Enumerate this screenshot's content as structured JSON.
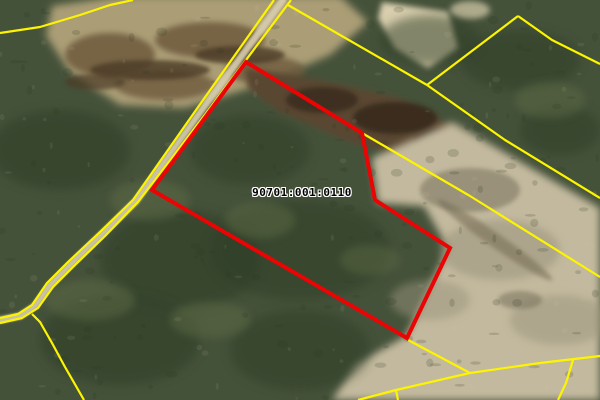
{
  "map": {
    "width": 600,
    "height": 400,
    "parcel_label": {
      "text": "90701:001:0110",
      "x": 302,
      "y": 186
    },
    "colors": {
      "boundary_yellow": "#fdf500",
      "selected_parcel_red": "#ea0404",
      "forest_base": "#45523a",
      "forest_dark": "#2a3520",
      "forest_light": "#5d6b44",
      "marsh_tan": "#ab9e76",
      "marsh_brown": "#6e5a3e",
      "marsh_dark_brown": "#46351f",
      "sand_light": "#d9cfae",
      "field_tan": "#c3b99e",
      "field_mottle": "#8f8a70",
      "road_surface": "#d8ceae",
      "label_text": "#000000",
      "label_halo": "#ffffff"
    },
    "selected_parcel": {
      "name": "selected-parcel-outline",
      "stroke_width": 4,
      "points": [
        [
          246,
          62
        ],
        [
          362,
          133
        ],
        [
          375,
          200
        ],
        [
          386,
          207
        ],
        [
          450,
          248
        ],
        [
          407,
          338
        ],
        [
          152,
          190
        ]
      ]
    },
    "cadastral_lines": [
      {
        "name": "boundary-top-left-curve",
        "points": [
          [
            0,
            33
          ],
          [
            40,
            27
          ],
          [
            80,
            15
          ],
          [
            110,
            5
          ],
          [
            133,
            0
          ]
        ]
      },
      {
        "name": "road-edge-west",
        "points": [
          [
            274,
            0
          ],
          [
            196,
            110
          ],
          [
            133,
            200
          ],
          [
            100,
            232
          ],
          [
            68,
            262
          ],
          [
            47,
            283
          ],
          [
            32,
            305
          ],
          [
            18,
            314
          ],
          [
            0,
            318
          ]
        ]
      },
      {
        "name": "road-edge-east",
        "points": [
          [
            291,
            0
          ],
          [
            207,
            112
          ],
          [
            138,
            202
          ],
          [
            105,
            236
          ],
          [
            74,
            266
          ],
          [
            53,
            287
          ],
          [
            38,
            308
          ],
          [
            22,
            318
          ],
          [
            0,
            323
          ]
        ]
      },
      {
        "name": "boundary-branch-southwest",
        "points": [
          [
            32,
            314
          ],
          [
            40,
            322
          ],
          [
            52,
            343
          ],
          [
            65,
            367
          ],
          [
            84,
            400
          ]
        ]
      },
      {
        "name": "boundary-road-to-junction",
        "points": [
          [
            288,
            5
          ],
          [
            427,
            85
          ]
        ]
      },
      {
        "name": "boundary-junction-to-peak",
        "points": [
          [
            427,
            85
          ],
          [
            518,
            16
          ]
        ]
      },
      {
        "name": "boundary-peak-east",
        "points": [
          [
            518,
            16
          ],
          [
            552,
            40
          ],
          [
            600,
            64
          ]
        ]
      },
      {
        "name": "boundary-junction-southeast",
        "points": [
          [
            427,
            85
          ],
          [
            505,
            140
          ],
          [
            600,
            198
          ]
        ]
      },
      {
        "name": "boundary-under-parcel-east",
        "points": [
          [
            362,
            133
          ],
          [
            470,
            196
          ],
          [
            600,
            277
          ]
        ]
      },
      {
        "name": "boundary-from-parcel-corner",
        "points": [
          [
            408,
            340
          ],
          [
            470,
            373
          ]
        ]
      },
      {
        "name": "boundary-bottom-long",
        "points": [
          [
            600,
            356
          ],
          [
            540,
            363
          ],
          [
            470,
            373
          ],
          [
            396,
            390
          ],
          [
            358,
            400
          ]
        ]
      },
      {
        "name": "boundary-bottom-stub",
        "points": [
          [
            396,
            390
          ],
          [
            398,
            400
          ]
        ]
      },
      {
        "name": "boundary-bottom-right-drop",
        "points": [
          [
            573,
            360
          ],
          [
            566,
            383
          ],
          [
            558,
            400
          ]
        ]
      }
    ],
    "terrain_patches": [
      {
        "name": "marsh-top-left",
        "type": "polygon",
        "fill": "#ab9e76",
        "opacity": 1,
        "blur": "f4",
        "points": [
          [
            52,
            6
          ],
          [
            120,
            -4
          ],
          [
            340,
            -4
          ],
          [
            368,
            22
          ],
          [
            330,
            55
          ],
          [
            260,
            85
          ],
          [
            185,
            108
          ],
          [
            120,
            105
          ],
          [
            70,
            72
          ],
          [
            46,
            36
          ]
        ]
      },
      {
        "name": "marsh-brown-1",
        "type": "ellipse",
        "fill": "#6e5a3e",
        "opacity": 0.85,
        "blur": "f3",
        "cx": 110,
        "cy": 55,
        "rx": 45,
        "ry": 22
      },
      {
        "name": "marsh-brown-2",
        "type": "ellipse",
        "fill": "#6e5a3e",
        "opacity": 0.85,
        "blur": "f3",
        "cx": 210,
        "cy": 40,
        "rx": 55,
        "ry": 18
      },
      {
        "name": "marsh-brown-3",
        "type": "ellipse",
        "fill": "#6e5a3e",
        "opacity": 0.8,
        "blur": "f3",
        "cx": 165,
        "cy": 85,
        "rx": 50,
        "ry": 15
      },
      {
        "name": "marsh-brown-4",
        "type": "ellipse",
        "fill": "#6e5a3e",
        "opacity": 0.8,
        "blur": "f3",
        "cx": 265,
        "cy": 70,
        "rx": 40,
        "ry": 14
      },
      {
        "name": "marsh-streak-1",
        "type": "ellipse",
        "fill": "#4c3b27",
        "opacity": 0.8,
        "blur": "f2",
        "cx": 150,
        "cy": 70,
        "rx": 60,
        "ry": 10
      },
      {
        "name": "marsh-streak-2",
        "type": "ellipse",
        "fill": "#4c3b27",
        "opacity": 0.8,
        "blur": "f2",
        "cx": 240,
        "cy": 55,
        "rx": 45,
        "ry": 9
      },
      {
        "name": "marsh-streak-3",
        "type": "ellipse",
        "fill": "#4c3b27",
        "opacity": 0.7,
        "blur": "f2",
        "cx": 95,
        "cy": 82,
        "rx": 30,
        "ry": 8
      },
      {
        "name": "parcel-marsh-band",
        "type": "polygon",
        "fill": "#5a4730",
        "opacity": 1,
        "blur": "f3",
        "points": [
          [
            245,
            68
          ],
          [
            320,
            80
          ],
          [
            400,
            98
          ],
          [
            462,
            132
          ],
          [
            470,
            152
          ],
          [
            430,
            162
          ],
          [
            350,
            142
          ],
          [
            280,
            112
          ],
          [
            248,
            88
          ]
        ]
      },
      {
        "name": "parcel-marsh-dark-1",
        "type": "ellipse",
        "fill": "#382b1b",
        "opacity": 0.9,
        "blur": "f2",
        "cx": 395,
        "cy": 118,
        "rx": 42,
        "ry": 16
      },
      {
        "name": "parcel-marsh-dark-2",
        "type": "ellipse",
        "fill": "#382b1b",
        "opacity": 0.85,
        "blur": "f2",
        "cx": 440,
        "cy": 140,
        "rx": 26,
        "ry": 12
      },
      {
        "name": "parcel-marsh-dark-3",
        "type": "ellipse",
        "fill": "#382b1b",
        "opacity": 0.8,
        "blur": "f2",
        "cx": 322,
        "cy": 100,
        "rx": 36,
        "ry": 13
      },
      {
        "name": "sand-top-right",
        "type": "polygon",
        "fill": "#d9cfae",
        "opacity": 1,
        "blur": "f3",
        "points": [
          [
            382,
            2
          ],
          [
            448,
            12
          ],
          [
            458,
            48
          ],
          [
            428,
            68
          ],
          [
            395,
            48
          ],
          [
            378,
            18
          ]
        ]
      },
      {
        "name": "sand-top-right-2",
        "type": "ellipse",
        "fill": "#d9cfae",
        "opacity": 0.7,
        "blur": "f3",
        "cx": 470,
        "cy": 10,
        "rx": 20,
        "ry": 9
      },
      {
        "name": "field-southeast",
        "type": "polygon",
        "fill": "#c3b99e",
        "opacity": 1,
        "blur": "f4",
        "points": [
          [
            378,
            203
          ],
          [
            372,
            158
          ],
          [
            452,
            122
          ],
          [
            600,
            208
          ],
          [
            600,
            400
          ],
          [
            332,
            400
          ],
          [
            356,
            364
          ],
          [
            406,
            336
          ],
          [
            448,
            248
          ],
          [
            424,
            206
          ]
        ]
      },
      {
        "name": "field-mottle-1",
        "type": "ellipse",
        "fill": "#9a947c",
        "opacity": 0.55,
        "blur": "f4",
        "cx": 500,
        "cy": 250,
        "rx": 60,
        "ry": 30
      },
      {
        "name": "field-mottle-2",
        "type": "ellipse",
        "fill": "#9a947c",
        "opacity": 0.5,
        "blur": "f4",
        "cx": 430,
        "cy": 300,
        "rx": 40,
        "ry": 20
      },
      {
        "name": "field-mottle-3",
        "type": "ellipse",
        "fill": "#9a947c",
        "opacity": 0.5,
        "blur": "f4",
        "cx": 560,
        "cy": 320,
        "rx": 50,
        "ry": 25
      },
      {
        "name": "field-dark-streak",
        "type": "ellipse",
        "fill": "#7a7058",
        "opacity": 0.6,
        "blur": "f2",
        "cx": 495,
        "cy": 240,
        "rx": 70,
        "ry": 7,
        "rot": 35
      },
      {
        "name": "field-dark-1",
        "type": "ellipse",
        "fill": "#6f6a55",
        "opacity": 0.5,
        "blur": "f2",
        "cx": 470,
        "cy": 190,
        "rx": 50,
        "ry": 22
      },
      {
        "name": "field-dark-2",
        "type": "ellipse",
        "fill": "#6f6a55",
        "opacity": 0.5,
        "blur": "f2",
        "cx": 520,
        "cy": 300,
        "rx": 22,
        "ry": 9
      },
      {
        "name": "forest-dark-1",
        "type": "ellipse",
        "fill": "#2f3c26",
        "opacity": 0.55,
        "blur": "f5",
        "cx": 60,
        "cy": 150,
        "rx": 70,
        "ry": 40
      },
      {
        "name": "forest-dark-2",
        "type": "ellipse",
        "fill": "#2f3c26",
        "opacity": 0.55,
        "blur": "f5",
        "cx": 180,
        "cy": 260,
        "rx": 80,
        "ry": 50
      },
      {
        "name": "forest-dark-3",
        "type": "ellipse",
        "fill": "#2f3c26",
        "opacity": 0.5,
        "blur": "f5",
        "cx": 300,
        "cy": 250,
        "rx": 90,
        "ry": 50
      },
      {
        "name": "forest-dark-4",
        "type": "ellipse",
        "fill": "#2f3c26",
        "opacity": 0.55,
        "blur": "f5",
        "cx": 120,
        "cy": 340,
        "rx": 80,
        "ry": 45
      },
      {
        "name": "forest-dark-5",
        "type": "ellipse",
        "fill": "#2f3c26",
        "opacity": 0.5,
        "blur": "f5",
        "cx": 250,
        "cy": 150,
        "rx": 60,
        "ry": 35
      },
      {
        "name": "forest-dark-6",
        "type": "ellipse",
        "fill": "#2f3c26",
        "opacity": 0.5,
        "blur": "f5",
        "cx": 430,
        "cy": 40,
        "rx": 50,
        "ry": 25
      },
      {
        "name": "forest-dark-7",
        "type": "ellipse",
        "fill": "#2f3c26",
        "opacity": 0.5,
        "blur": "f5",
        "cx": 520,
        "cy": 60,
        "rx": 60,
        "ry": 30
      },
      {
        "name": "forest-dark-8",
        "type": "ellipse",
        "fill": "#2f3c26",
        "opacity": 0.5,
        "blur": "f5",
        "cx": 560,
        "cy": 130,
        "rx": 40,
        "ry": 25
      },
      {
        "name": "forest-dark-9",
        "type": "ellipse",
        "fill": "#2f3c26",
        "opacity": 0.5,
        "blur": "f5",
        "cx": 300,
        "cy": 350,
        "rx": 70,
        "ry": 40
      },
      {
        "name": "forest-light-1",
        "type": "ellipse",
        "fill": "#5d6b44",
        "opacity": 0.5,
        "blur": "f4",
        "cx": 150,
        "cy": 200,
        "rx": 40,
        "ry": 20
      },
      {
        "name": "forest-light-2",
        "type": "ellipse",
        "fill": "#5d6b44",
        "opacity": 0.5,
        "blur": "f4",
        "cx": 260,
        "cy": 220,
        "rx": 35,
        "ry": 18
      },
      {
        "name": "forest-light-3",
        "type": "ellipse",
        "fill": "#5d6b44",
        "opacity": 0.5,
        "blur": "f4",
        "cx": 90,
        "cy": 300,
        "rx": 45,
        "ry": 20
      },
      {
        "name": "forest-light-4",
        "type": "ellipse",
        "fill": "#5d6b44",
        "opacity": 0.5,
        "blur": "f4",
        "cx": 210,
        "cy": 320,
        "rx": 40,
        "ry": 18
      },
      {
        "name": "forest-light-5",
        "type": "ellipse",
        "fill": "#5d6b44",
        "opacity": 0.5,
        "blur": "f4",
        "cx": 550,
        "cy": 100,
        "rx": 35,
        "ry": 18
      },
      {
        "name": "forest-light-6",
        "type": "ellipse",
        "fill": "#5d6b44",
        "opacity": 0.45,
        "blur": "f4",
        "cx": 370,
        "cy": 260,
        "rx": 30,
        "ry": 15
      },
      {
        "name": "road-surface",
        "type": "stroke",
        "stroke": "#d8ceae",
        "width": 7,
        "opacity": 0.9,
        "blur": "f1",
        "points": [
          [
            283,
            0
          ],
          [
            201,
            111
          ],
          [
            136,
            201
          ],
          [
            102,
            234
          ],
          [
            71,
            264
          ],
          [
            50,
            285
          ],
          [
            35,
            306
          ],
          [
            20,
            316
          ],
          [
            0,
            320
          ]
        ]
      }
    ]
  }
}
